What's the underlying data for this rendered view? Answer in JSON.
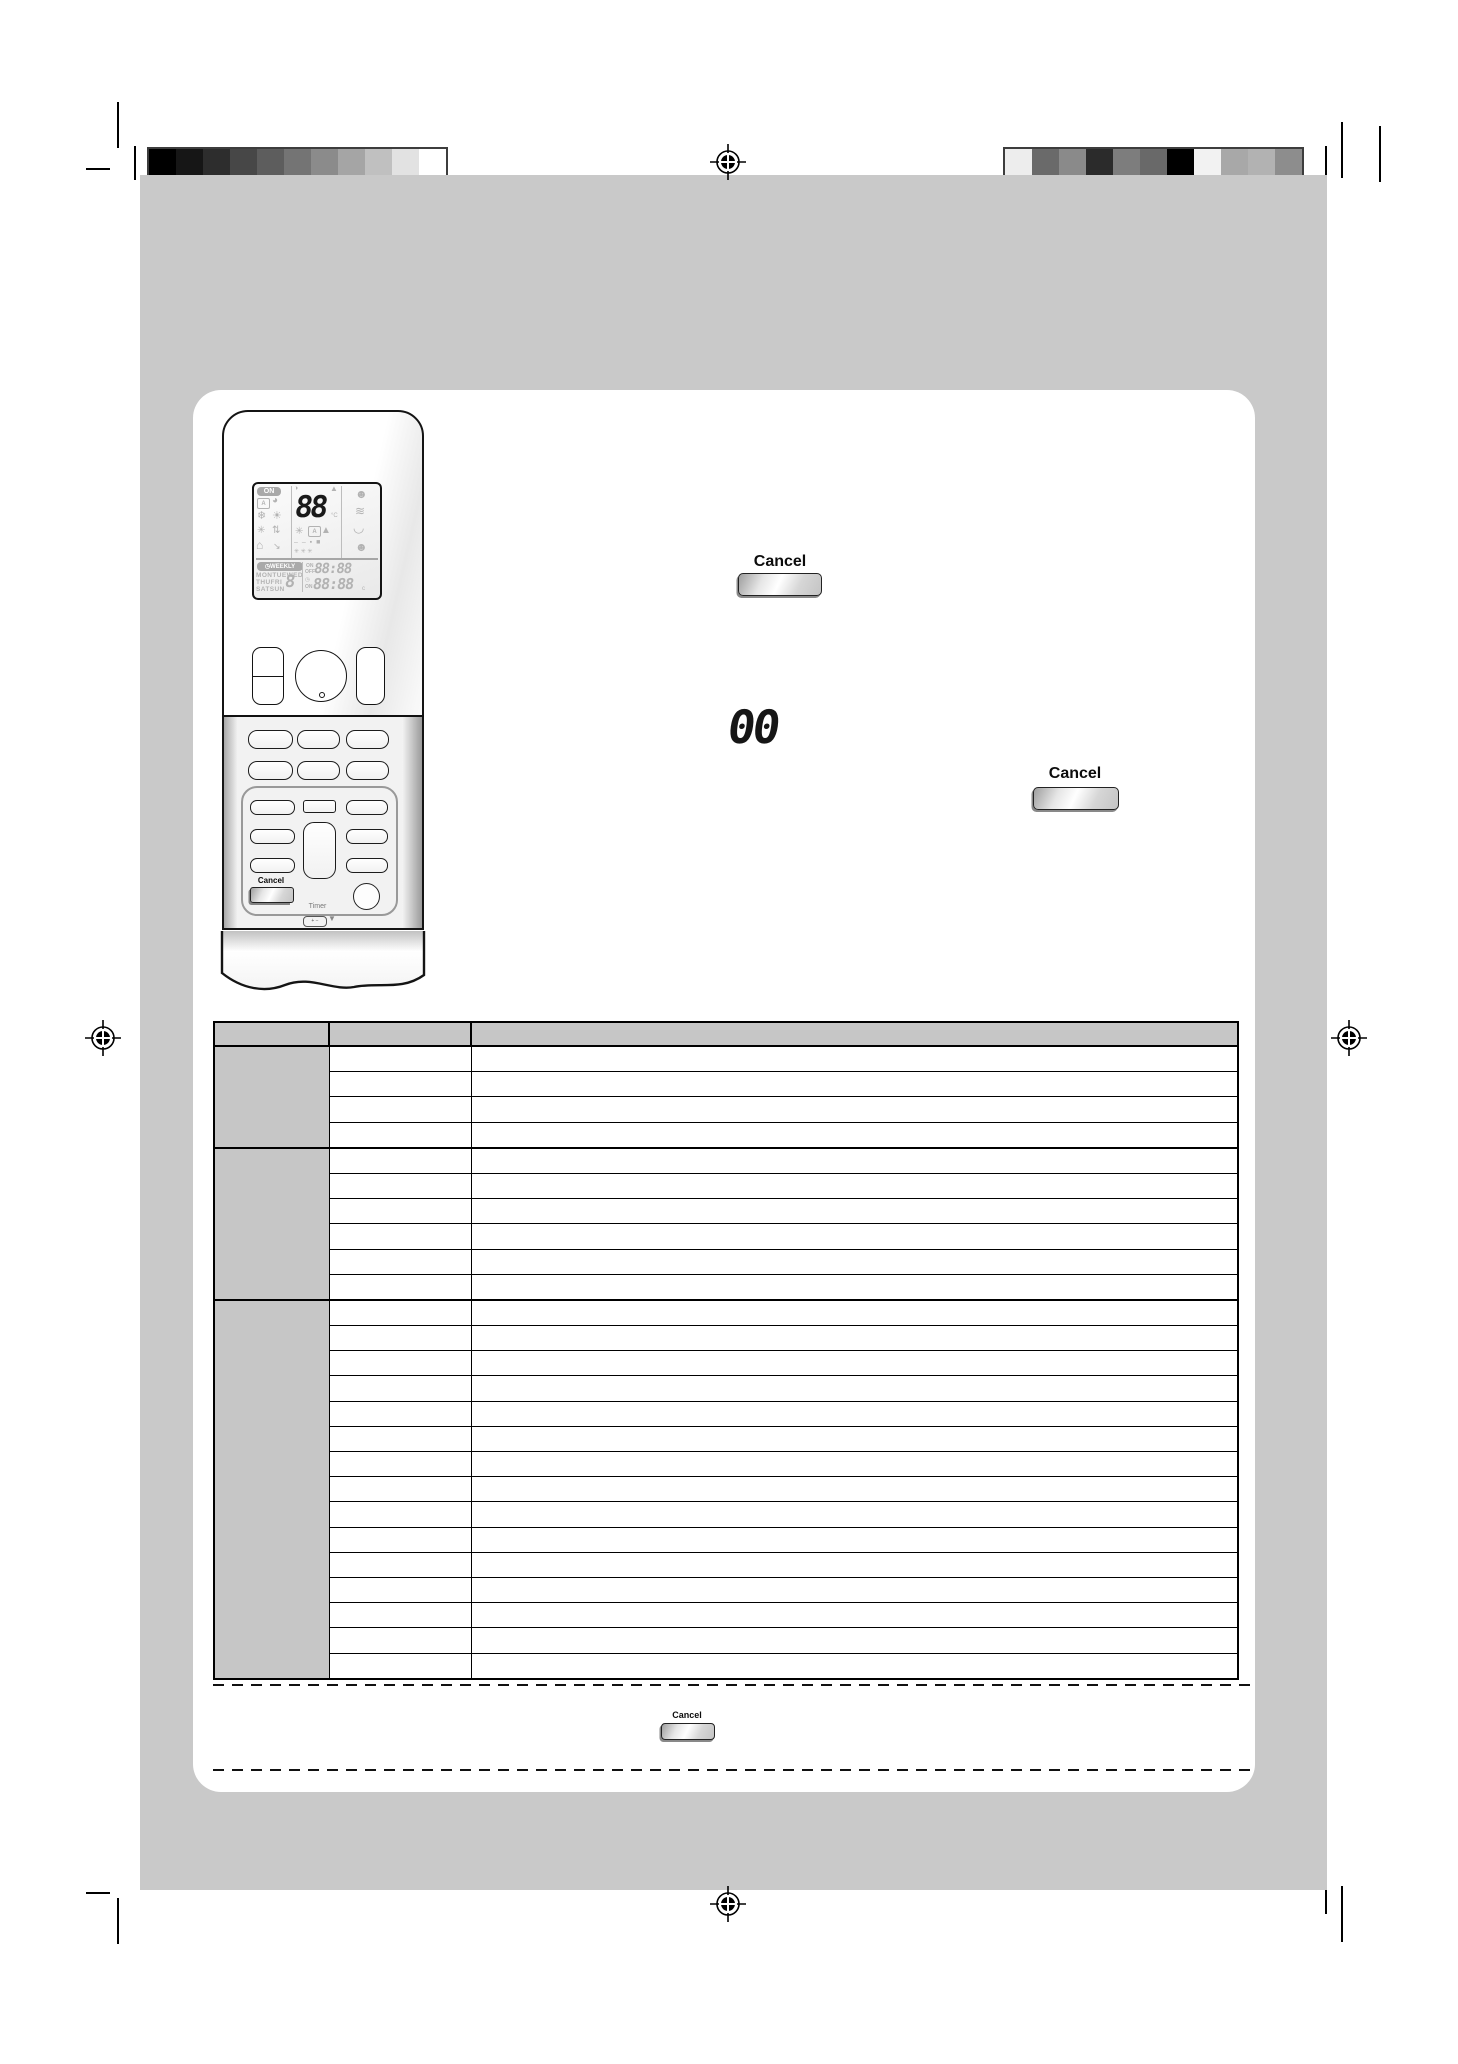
{
  "page": {
    "sheet_color": "#c9c9c9",
    "panel_color": "#ffffff"
  },
  "print_marks": {
    "grayscale_bar": [
      "#000000",
      "#161616",
      "#2d2d2d",
      "#474747",
      "#5d5d5d",
      "#747474",
      "#8b8b8b",
      "#a5a5a5",
      "#c0c0c0",
      "#e2e2e2",
      "#ffffff"
    ],
    "color_bar": [
      "#ededed",
      "#6a6a6a",
      "#8a8a8a",
      "#2b2b2b",
      "#7d7d7d",
      "#696969",
      "#000000",
      "#f2f2f2",
      "#a8a8a8",
      "#b2b2b2",
      "#8d8d8d"
    ]
  },
  "remote": {
    "lcd": {
      "power_badge": "ON",
      "temperature_digits": "88",
      "temp_unit": "°C",
      "weekly_badge": "◷WEEKLY",
      "days_row1": "MONTUEWED",
      "days_row2": "THUFRI",
      "days_row3": "SATSUN",
      "program_digit": "8",
      "timer_on_label": "ON",
      "timer_off_label": "OFF",
      "timer_time_top": "88:88",
      "clock_glyph": "◷",
      "timer_on_label2": "ON",
      "timer_time_bottom": "88:88",
      "time_unit": "c",
      "icons": {
        "power_dot": "◑",
        "up_triangle": "▲",
        "auto_mode": "A",
        "comfort": "◕",
        "cool": "❄",
        "heat": "☀",
        "fan_only": "✳",
        "dry": "⇅",
        "indoor_unit": "⌂",
        "airflow_arrow": "↘",
        "fan_small": "✳",
        "auto_fan": "A",
        "quiet_tree": "▲",
        "level_row": "– – ▪ ■",
        "fan_row": "✳ ✳ ✳",
        "presence_sensor": "☻",
        "wind": "≋",
        "swing": "◡",
        "intelligent_eye": "☻"
      }
    },
    "cancel_button_label": "Cancel",
    "timer_group_label": "Timer",
    "battery_label": "+ −",
    "down_arrow": "▼"
  },
  "figures": {
    "step1_cancel_label": "Cancel",
    "display_readout": "00",
    "step2_cancel_label": "Cancel",
    "note_cancel_label": "Cancel"
  },
  "table": {
    "header": [
      "",
      "",
      ""
    ],
    "sections": [
      {
        "rows": 4
      },
      {
        "rows": 6
      },
      {
        "rows": 15
      }
    ]
  }
}
